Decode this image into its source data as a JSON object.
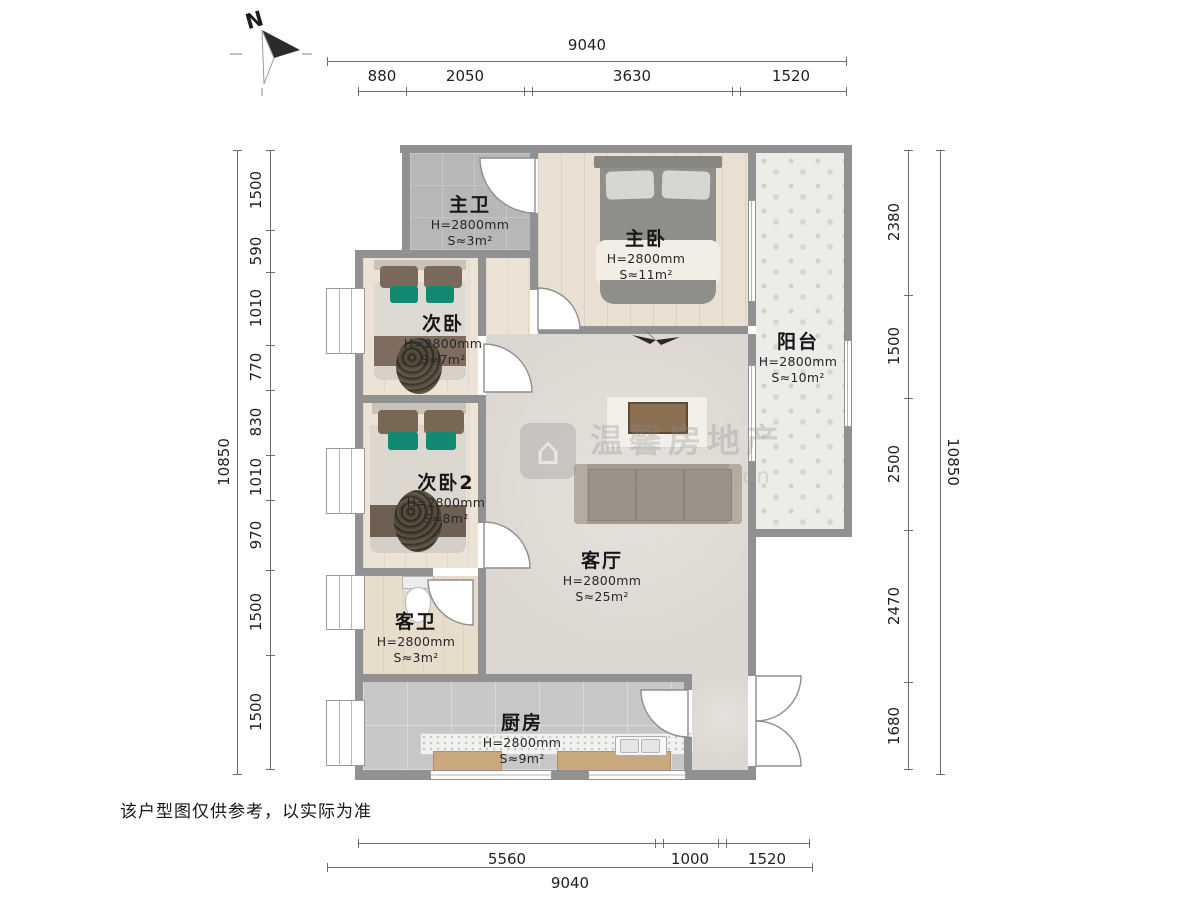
{
  "compass": {
    "north": "N"
  },
  "watermark": {
    "brand": "温馨房地产",
    "url": "www.fc100.cn"
  },
  "disclaimer": "该户型图仅供参考，以实际为准",
  "rooms": {
    "master_bath": {
      "name": "主卫",
      "height": "H=2800mm",
      "area": "S≈3m²"
    },
    "master_bedroom": {
      "name": "主卧",
      "height": "H=2800mm",
      "area": "S≈11m²"
    },
    "bedroom2": {
      "name": "次卧",
      "height": "H=2800mm",
      "area": "S≈7m²"
    },
    "bedroom3": {
      "name": "次卧2",
      "height": "H=2800mm",
      "area": "S≈8m²"
    },
    "guest_bath": {
      "name": "客卫",
      "height": "H=2800mm",
      "area": "S≈3m²"
    },
    "living_room": {
      "name": "客厅",
      "height": "H=2800mm",
      "area": "S≈25m²"
    },
    "kitchen": {
      "name": "厨房",
      "height": "H=2800mm",
      "area": "S≈9m²"
    },
    "balcony": {
      "name": "阳台",
      "height": "H=2800mm",
      "area": "S≈10m²"
    }
  },
  "dimensions": {
    "top": {
      "total": "9040",
      "segments": [
        "880",
        "2050",
        "3630",
        "1520"
      ]
    },
    "bottom": {
      "total": "9040",
      "segments": [
        "5560",
        "1000",
        "1520"
      ]
    },
    "left": {
      "total": "10850",
      "segments": [
        "1500",
        "590",
        "1010",
        "770",
        "830",
        "1010",
        "970",
        "1500",
        "1500"
      ]
    },
    "right": {
      "total": "10850",
      "segments": [
        "2380",
        "1500",
        "2500",
        "2470",
        "1680"
      ]
    }
  }
}
